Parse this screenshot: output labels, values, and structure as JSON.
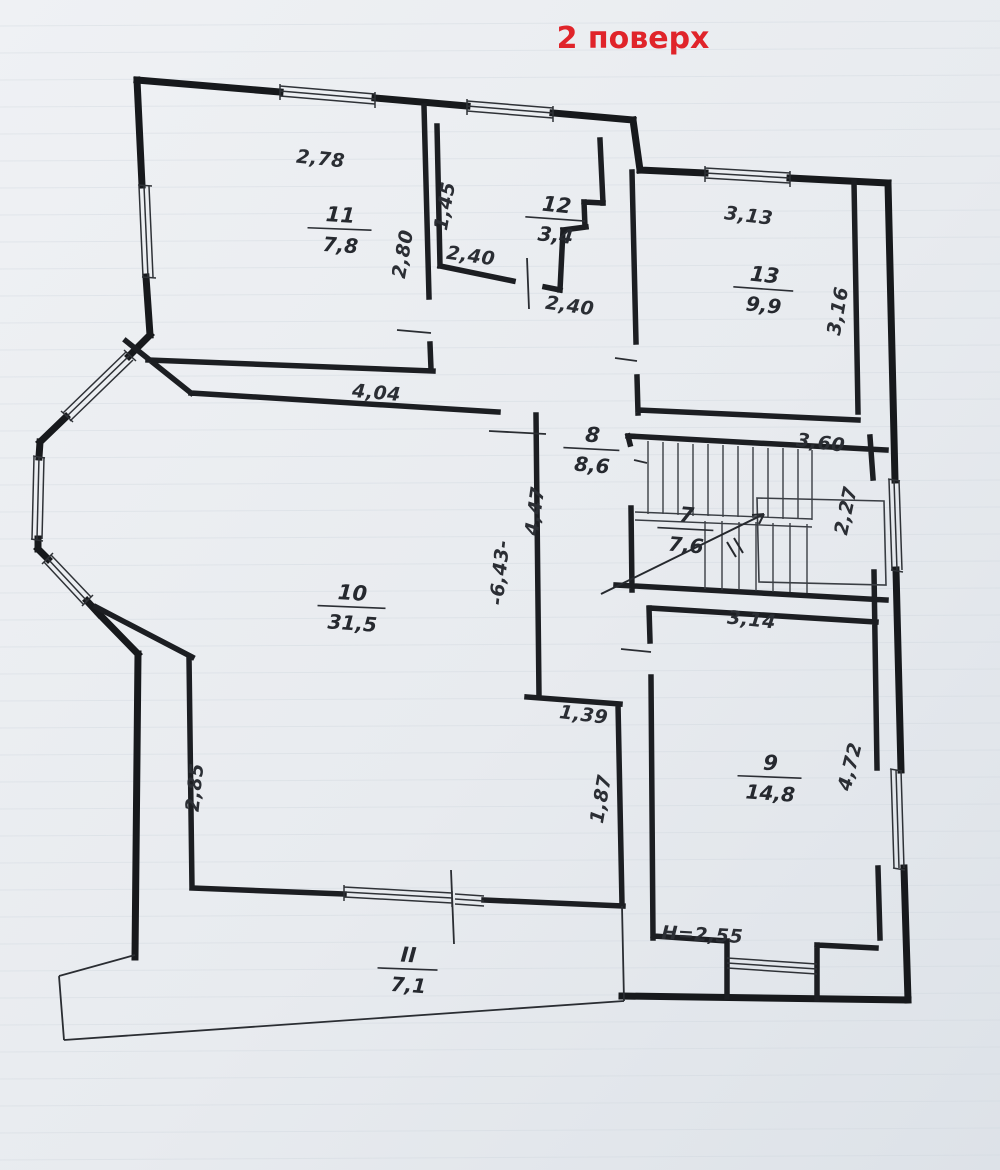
{
  "title": "2 поверх",
  "title_color": "#e0242a",
  "paper_color": "#e9ecf0",
  "ink_color": "#1a1c1f",
  "floor_label": "second-floor-plan",
  "rooms": [
    {
      "number": "11",
      "area": "7,8"
    },
    {
      "number": "12",
      "area": "3,4"
    },
    {
      "number": "13",
      "area": "9,9"
    },
    {
      "number": "8",
      "area": "8,6"
    },
    {
      "number": "7",
      "area": "7,6"
    },
    {
      "number": "10",
      "area": "31,5"
    },
    {
      "number": "9",
      "area": "14,8"
    },
    {
      "number": "II",
      "area": "7,1"
    }
  ],
  "dims": {
    "room11_width": "2,78",
    "room12_left": "1,45",
    "room11_right": "2,80",
    "room12_bottom": "2,40",
    "corridor": "2,40",
    "room13_top": "3,13",
    "room13_right": "3,16",
    "room10_top": "4,04",
    "stair_top": "3,60",
    "stair_right": "2,27",
    "hall_left": "4,47",
    "room10_right": "-6,43-",
    "passage_top": "1,39",
    "passage_right": "1,87",
    "room10_left": "2,85",
    "room9_top": "3,14",
    "room9_right": "4,72",
    "ceiling_height": "H=2,55"
  }
}
